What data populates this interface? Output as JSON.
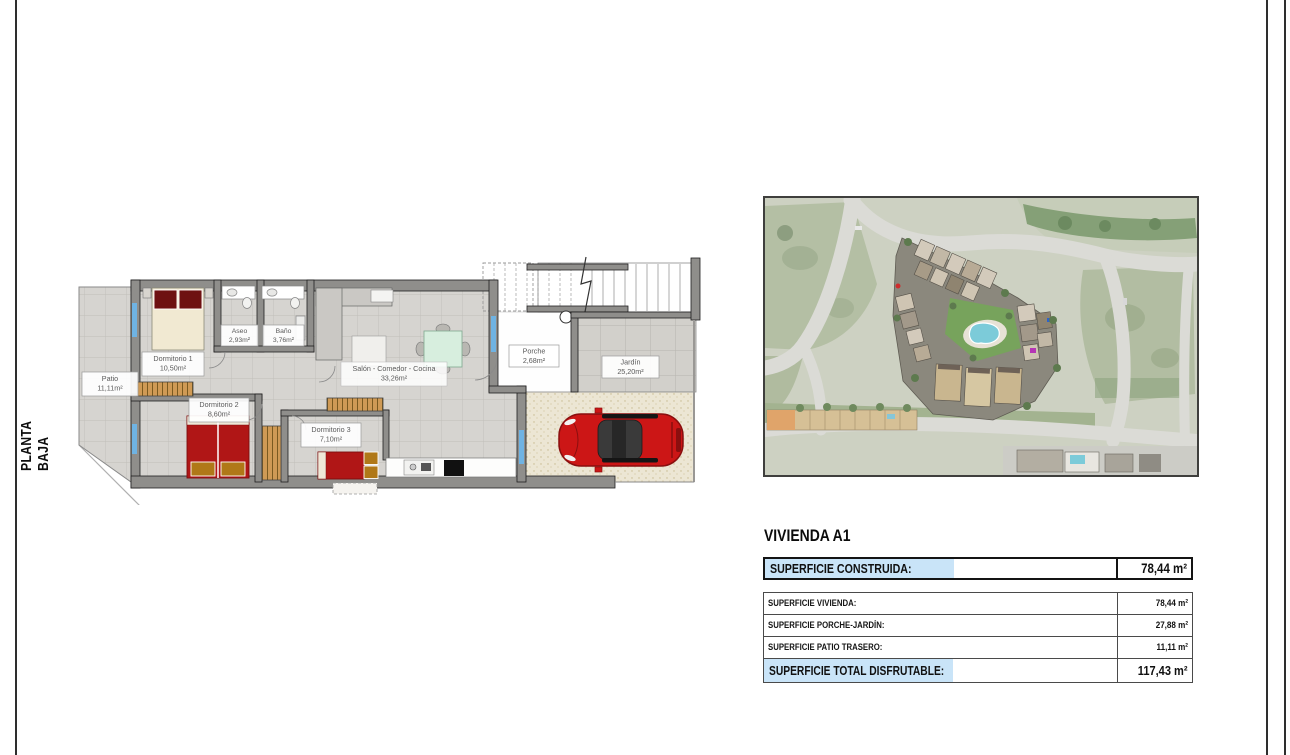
{
  "document": {
    "side_label": "PLANTA BAJA"
  },
  "floor_plan": {
    "rooms": [
      {
        "name": "Patio",
        "area": "11,11m²"
      },
      {
        "name": "Dormitorio 1",
        "area": "10,50m²"
      },
      {
        "name": "Aseo",
        "area": "2,93m²"
      },
      {
        "name": "Baño",
        "area": "3,76m²"
      },
      {
        "name": "Salón - Comedor - Cocina",
        "area": "33,26m²"
      },
      {
        "name": "Dormitorio 2",
        "area": "8,60m²"
      },
      {
        "name": "Dormitorio 3",
        "area": "7,10m²"
      },
      {
        "name": "Porche",
        "area": "2,68m²"
      },
      {
        "name": "Jardín",
        "area": "25,20m²"
      }
    ]
  },
  "summary_panel": {
    "title": "VIVIENDA A1",
    "construida": {
      "label": "SUPERFICIE CONSTRUIDA:",
      "value": "78,44 m²"
    },
    "details": [
      {
        "label": "SUPERFICIE VIVIENDA:",
        "value": "78,44 m²"
      },
      {
        "label": "SUPERFICIE PORCHE-JARDÍN:",
        "value": "27,88 m²"
      },
      {
        "label": "SUPERFICIE PATIO TRASERO:",
        "value": "11,11 m²"
      }
    ],
    "total": {
      "label": "SUPERFICIE TOTAL DISFRUTABLE:",
      "value": "117,43 m²"
    }
  },
  "colors": {
    "highlight_blue": "#c9e4f8",
    "car_red": "#cc1616",
    "pool_cyan": "#7ccbd9"
  }
}
